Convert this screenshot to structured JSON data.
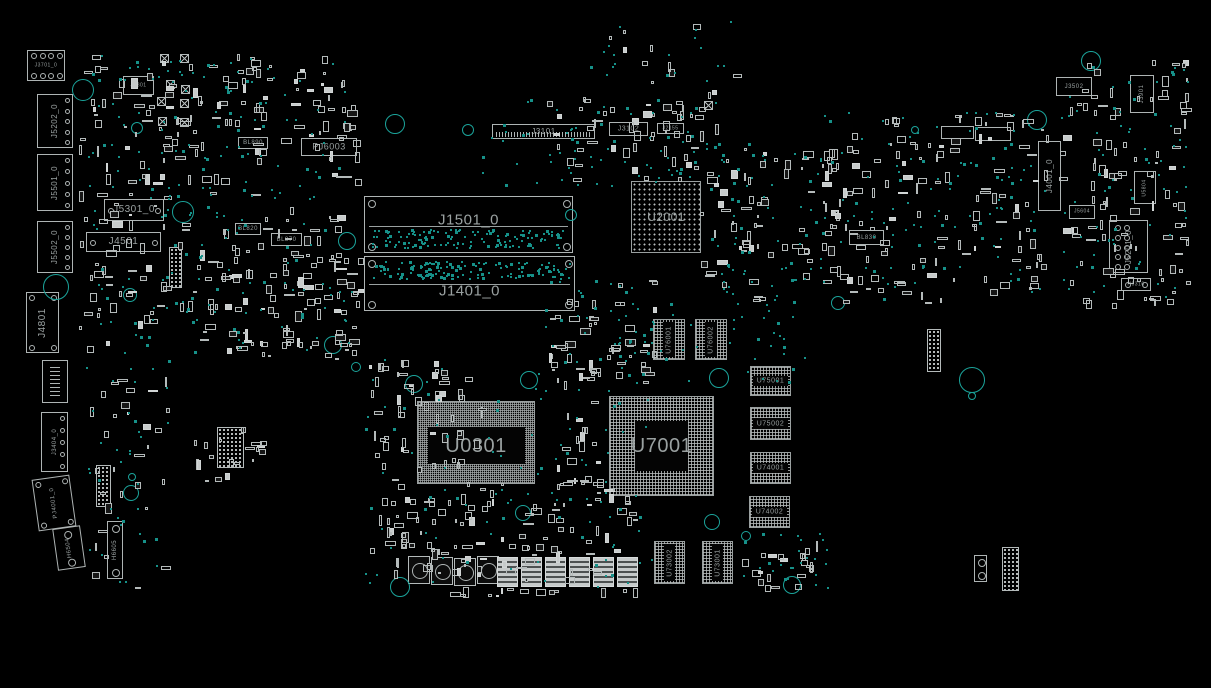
{
  "board": {
    "width": 1211,
    "height": 688,
    "background": "#000000",
    "outline_color": "#aeb4b4",
    "label_color": "#9aa1a1",
    "testpoint_color": "#169189",
    "hole_color": "#1ba49b"
  },
  "components": [
    {
      "label": "J3701_0",
      "x": 27,
      "y": 50,
      "w": 38,
      "h": 31,
      "type": "conn",
      "fs": 5,
      "pins": "tb"
    },
    {
      "label": "J5202_0",
      "x": 37,
      "y": 94,
      "w": 36,
      "h": 54,
      "type": "conn",
      "rot": 1,
      "fs": 8,
      "pins": "rcol"
    },
    {
      "label": "J5501_0",
      "x": 37,
      "y": 154,
      "w": 36,
      "h": 57,
      "type": "conn",
      "rot": 1,
      "fs": 8,
      "pins": "rcol"
    },
    {
      "label": "J5502_0",
      "x": 37,
      "y": 221,
      "w": 36,
      "h": 52,
      "type": "conn",
      "rot": 1,
      "fs": 8,
      "pins": "rcol"
    },
    {
      "label": "J4801",
      "x": 26,
      "y": 292,
      "w": 33,
      "h": 61,
      "type": "conn",
      "rot": 1,
      "fs": 10,
      "pins": "corners"
    },
    {
      "label": "",
      "x": 42,
      "y": 360,
      "w": 26,
      "h": 43,
      "type": "coil"
    },
    {
      "label": "J3404_0",
      "x": 41,
      "y": 412,
      "w": 27,
      "h": 60,
      "type": "conn",
      "rot": 1,
      "fs": 6,
      "pins": "rcol"
    },
    {
      "label": "PJ4001_0",
      "x": 35,
      "y": 477,
      "w": 38,
      "h": 52,
      "type": "conn",
      "rot": 1,
      "fs": 6,
      "tilt": -8,
      "pins": "corners"
    },
    {
      "label": "H6504",
      "x": 55,
      "y": 527,
      "w": 28,
      "h": 42,
      "type": "conn",
      "rot": 1,
      "fs": 6,
      "tilt": -8,
      "pins": "tb2"
    },
    {
      "label": "H6605",
      "x": 107,
      "y": 521,
      "w": 16,
      "h": 58,
      "type": "conn",
      "rot": 1,
      "fs": 6,
      "pins": "tb2"
    },
    {
      "label": "J5801",
      "x": 123,
      "y": 76,
      "w": 31,
      "h": 19,
      "type": "conn",
      "fs": 5
    },
    {
      "label": "BL890",
      "x": 238,
      "y": 137,
      "w": 30,
      "h": 12,
      "type": "conn",
      "fs": 6
    },
    {
      "label": "PJ6003",
      "x": 301,
      "y": 138,
      "w": 56,
      "h": 18,
      "type": "conn",
      "fs": 9
    },
    {
      "label": "J5301_0",
      "x": 104,
      "y": 199,
      "w": 60,
      "h": 22,
      "type": "conn",
      "fs": 10,
      "pins": "lr"
    },
    {
      "label": "J4501",
      "x": 86,
      "y": 232,
      "w": 75,
      "h": 20,
      "type": "conn",
      "fs": 10,
      "pins": "lr"
    },
    {
      "label": "BL820",
      "x": 235,
      "y": 223,
      "w": 26,
      "h": 12,
      "type": "conn",
      "fs": 6
    },
    {
      "label": "BL870",
      "x": 271,
      "y": 233,
      "w": 31,
      "h": 13,
      "type": "conn",
      "fs": 6
    },
    {
      "label": "J1501_0",
      "x": 364,
      "y": 196,
      "w": 209,
      "h": 57,
      "type": "dimm",
      "fs": 15,
      "ly": 0.42,
      "line": 0.52
    },
    {
      "label": "J1401_0",
      "x": 364,
      "y": 256,
      "w": 211,
      "h": 55,
      "type": "dimm",
      "fs": 15,
      "ly": 0.64,
      "line": 0.5
    },
    {
      "label": "J3101",
      "x": 492,
      "y": 124,
      "w": 103,
      "h": 15,
      "type": "conn",
      "fs": 8,
      "hatch": 1
    },
    {
      "label": "J3102",
      "x": 609,
      "y": 122,
      "w": 39,
      "h": 14,
      "type": "conn",
      "fs": 7
    },
    {
      "label": "J2155",
      "x": 657,
      "y": 123,
      "w": 27,
      "h": 11,
      "type": "conn",
      "fs": 5
    },
    {
      "label": "U2001",
      "x": 631,
      "y": 181,
      "w": 70,
      "h": 72,
      "type": "bga-dots",
      "fs": 12
    },
    {
      "label": "BL830",
      "x": 849,
      "y": 230,
      "w": 35,
      "h": 15,
      "type": "conn",
      "fs": 6
    },
    {
      "label": "",
      "x": 941,
      "y": 126,
      "w": 33,
      "h": 13,
      "type": "conn"
    },
    {
      "label": "",
      "x": 975,
      "y": 127,
      "w": 36,
      "h": 14,
      "type": "conn"
    },
    {
      "label": "J3502",
      "x": 1056,
      "y": 77,
      "w": 36,
      "h": 19,
      "type": "conn",
      "fs": 6
    },
    {
      "label": "J3901",
      "x": 1130,
      "y": 75,
      "w": 24,
      "h": 38,
      "type": "conn",
      "rot": 1,
      "fs": 6
    },
    {
      "label": "J4001_0",
      "x": 1038,
      "y": 141,
      "w": 23,
      "h": 70,
      "type": "conn",
      "rot": 1,
      "fs": 8
    },
    {
      "label": "U5804",
      "x": 1134,
      "y": 171,
      "w": 22,
      "h": 33,
      "type": "conn",
      "rot": 1,
      "fs": 5
    },
    {
      "label": "J5604",
      "x": 1069,
      "y": 205,
      "w": 26,
      "h": 14,
      "type": "conn",
      "fs": 5
    },
    {
      "label": "J5201_0",
      "x": 1109,
      "y": 220,
      "w": 39,
      "h": 53,
      "type": "conn",
      "rot": 1,
      "fs": 8,
      "pins": "2col"
    },
    {
      "label": "H6316",
      "x": 1121,
      "y": 278,
      "w": 30,
      "h": 13,
      "type": "conn",
      "fs": 5,
      "pins": "lr"
    },
    {
      "label": "U0301",
      "x": 417,
      "y": 401,
      "w": 118,
      "h": 83,
      "type": "cpu",
      "fs": 20,
      "ly": 0.54
    },
    {
      "label": "U7001",
      "x": 609,
      "y": 396,
      "w": 105,
      "h": 100,
      "type": "bga-grid",
      "fs": 20
    },
    {
      "label": "U76001",
      "x": 653,
      "y": 319,
      "w": 32,
      "h": 41,
      "type": "mem-v",
      "fs": 7
    },
    {
      "label": "U76002",
      "x": 695,
      "y": 319,
      "w": 32,
      "h": 41,
      "type": "mem-v",
      "fs": 7
    },
    {
      "label": "U75001",
      "x": 750,
      "y": 366,
      "w": 41,
      "h": 30,
      "type": "mem-h",
      "fs": 7
    },
    {
      "label": "U75002",
      "x": 750,
      "y": 407,
      "w": 41,
      "h": 33,
      "type": "mem-h",
      "fs": 7
    },
    {
      "label": "U74001",
      "x": 750,
      "y": 452,
      "w": 41,
      "h": 32,
      "type": "mem-h",
      "fs": 7
    },
    {
      "label": "U74002",
      "x": 749,
      "y": 496,
      "w": 41,
      "h": 32,
      "type": "mem-h",
      "fs": 7
    },
    {
      "label": "U73002",
      "x": 654,
      "y": 541,
      "w": 31,
      "h": 43,
      "type": "mem-v",
      "fs": 7
    },
    {
      "label": "U73001",
      "x": 702,
      "y": 541,
      "w": 31,
      "h": 43,
      "type": "mem-v",
      "fs": 7
    },
    {
      "label": "",
      "x": 927,
      "y": 329,
      "w": 14,
      "h": 43,
      "type": "padgrid"
    },
    {
      "label": "",
      "x": 1002,
      "y": 547,
      "w": 17,
      "h": 44,
      "type": "padgrid"
    },
    {
      "label": "",
      "x": 974,
      "y": 555,
      "w": 13,
      "h": 27,
      "type": "conn",
      "pins": "tb2"
    },
    {
      "label": "",
      "x": 217,
      "y": 427,
      "w": 27,
      "h": 41,
      "type": "padgrid"
    },
    {
      "label": "",
      "x": 96,
      "y": 465,
      "w": 15,
      "h": 42,
      "type": "padgrid"
    },
    {
      "label": "",
      "x": 169,
      "y": 247,
      "w": 13,
      "h": 41,
      "type": "padgrid"
    },
    {
      "label": "",
      "x": 408,
      "y": 556,
      "w": 22,
      "h": 28,
      "type": "inductor"
    },
    {
      "label": "",
      "x": 431,
      "y": 557,
      "w": 22,
      "h": 28,
      "type": "inductor"
    },
    {
      "label": "",
      "x": 454,
      "y": 558,
      "w": 22,
      "h": 28,
      "type": "inductor"
    },
    {
      "label": "",
      "x": 477,
      "y": 556,
      "w": 22,
      "h": 28,
      "type": "inductor"
    },
    {
      "label": "",
      "x": 497,
      "y": 557,
      "w": 21,
      "h": 30,
      "type": "mosfet"
    },
    {
      "label": "",
      "x": 521,
      "y": 557,
      "w": 21,
      "h": 30,
      "type": "mosfet"
    },
    {
      "label": "",
      "x": 545,
      "y": 557,
      "w": 21,
      "h": 30,
      "type": "mosfet"
    },
    {
      "label": "",
      "x": 569,
      "y": 557,
      "w": 21,
      "h": 30,
      "type": "mosfet"
    },
    {
      "label": "",
      "x": 593,
      "y": 557,
      "w": 21,
      "h": 30,
      "type": "mosfet"
    },
    {
      "label": "",
      "x": 617,
      "y": 557,
      "w": 21,
      "h": 30,
      "type": "mosfet"
    }
  ],
  "holes": [
    {
      "x": 83,
      "y": 90,
      "r": 11
    },
    {
      "x": 56,
      "y": 287,
      "r": 13
    },
    {
      "x": 137,
      "y": 128,
      "r": 6
    },
    {
      "x": 183,
      "y": 212,
      "r": 11
    },
    {
      "x": 347,
      "y": 241,
      "r": 9
    },
    {
      "x": 395,
      "y": 124,
      "r": 10
    },
    {
      "x": 468,
      "y": 130,
      "r": 6
    },
    {
      "x": 571,
      "y": 215,
      "r": 6
    },
    {
      "x": 333,
      "y": 345,
      "r": 9
    },
    {
      "x": 356,
      "y": 367,
      "r": 5
    },
    {
      "x": 414,
      "y": 384,
      "r": 9
    },
    {
      "x": 529,
      "y": 380,
      "r": 9
    },
    {
      "x": 719,
      "y": 378,
      "r": 10
    },
    {
      "x": 972,
      "y": 380,
      "r": 13
    },
    {
      "x": 972,
      "y": 396,
      "r": 4
    },
    {
      "x": 1037,
      "y": 120,
      "r": 10
    },
    {
      "x": 1091,
      "y": 61,
      "r": 10
    },
    {
      "x": 132,
      "y": 477,
      "r": 4
    },
    {
      "x": 131,
      "y": 493,
      "r": 8
    },
    {
      "x": 400,
      "y": 587,
      "r": 10
    },
    {
      "x": 523,
      "y": 513,
      "r": 8
    },
    {
      "x": 746,
      "y": 536,
      "r": 5
    },
    {
      "x": 712,
      "y": 522,
      "r": 8
    },
    {
      "x": 792,
      "y": 585,
      "r": 9
    },
    {
      "x": 915,
      "y": 130,
      "r": 4
    },
    {
      "x": 130,
      "y": 295,
      "r": 7
    },
    {
      "x": 838,
      "y": 303,
      "r": 7
    }
  ],
  "fiducials": [
    {
      "x": 160,
      "y": 54
    },
    {
      "x": 180,
      "y": 54
    },
    {
      "x": 166,
      "y": 80
    },
    {
      "x": 181,
      "y": 85
    },
    {
      "x": 157,
      "y": 97
    },
    {
      "x": 180,
      "y": 99
    },
    {
      "x": 158,
      "y": 117
    },
    {
      "x": 180,
      "y": 118
    },
    {
      "x": 704,
      "y": 101
    }
  ],
  "smd_clusters": [
    {
      "x": 78,
      "y": 52,
      "w": 285,
      "h": 135,
      "n": 130
    },
    {
      "x": 78,
      "y": 190,
      "w": 285,
      "h": 165,
      "n": 130
    },
    {
      "x": 230,
      "y": 258,
      "w": 135,
      "h": 105,
      "n": 45
    },
    {
      "x": 368,
      "y": 360,
      "w": 120,
      "h": 225,
      "n": 80
    },
    {
      "x": 385,
      "y": 470,
      "w": 255,
      "h": 118,
      "n": 90
    },
    {
      "x": 545,
      "y": 88,
      "w": 175,
      "h": 95,
      "n": 55
    },
    {
      "x": 700,
      "y": 140,
      "w": 145,
      "h": 165,
      "n": 70
    },
    {
      "x": 822,
      "y": 112,
      "w": 230,
      "h": 195,
      "n": 130
    },
    {
      "x": 1058,
      "y": 60,
      "w": 135,
      "h": 250,
      "n": 100
    },
    {
      "x": 545,
      "y": 275,
      "w": 115,
      "h": 115,
      "n": 45
    },
    {
      "x": 553,
      "y": 360,
      "w": 55,
      "h": 140,
      "n": 30
    },
    {
      "x": 738,
      "y": 538,
      "w": 85,
      "h": 55,
      "n": 22
    },
    {
      "x": 88,
      "y": 360,
      "w": 85,
      "h": 230,
      "n": 30
    },
    {
      "x": 193,
      "y": 423,
      "w": 75,
      "h": 60,
      "n": 20
    },
    {
      "x": 593,
      "y": 18,
      "w": 150,
      "h": 70,
      "n": 10
    },
    {
      "x": 425,
      "y": 588,
      "w": 240,
      "h": 10,
      "n": 14
    }
  ],
  "dot_clusters": [
    {
      "x": 88,
      "y": 55,
      "w": 270,
      "h": 150,
      "n": 110
    },
    {
      "x": 88,
      "y": 205,
      "w": 270,
      "h": 150,
      "n": 90
    },
    {
      "x": 480,
      "y": 98,
      "w": 240,
      "h": 90,
      "n": 70
    },
    {
      "x": 700,
      "y": 140,
      "w": 120,
      "h": 160,
      "n": 60
    },
    {
      "x": 820,
      "y": 112,
      "w": 230,
      "h": 190,
      "n": 110
    },
    {
      "x": 1060,
      "y": 60,
      "w": 130,
      "h": 240,
      "n": 70
    },
    {
      "x": 365,
      "y": 355,
      "w": 290,
      "h": 235,
      "n": 100
    },
    {
      "x": 640,
      "y": 295,
      "w": 170,
      "h": 90,
      "n": 40
    },
    {
      "x": 85,
      "y": 355,
      "w": 90,
      "h": 230,
      "n": 35
    },
    {
      "x": 545,
      "y": 275,
      "w": 110,
      "h": 110,
      "n": 40
    },
    {
      "x": 740,
      "y": 530,
      "w": 90,
      "h": 60,
      "n": 25
    },
    {
      "x": 590,
      "y": 20,
      "w": 160,
      "h": 70,
      "n": 18
    },
    {
      "x": 370,
      "y": 229,
      "w": 198,
      "h": 21,
      "n": 140
    },
    {
      "x": 370,
      "y": 261,
      "w": 202,
      "h": 20,
      "n": 140
    }
  ]
}
